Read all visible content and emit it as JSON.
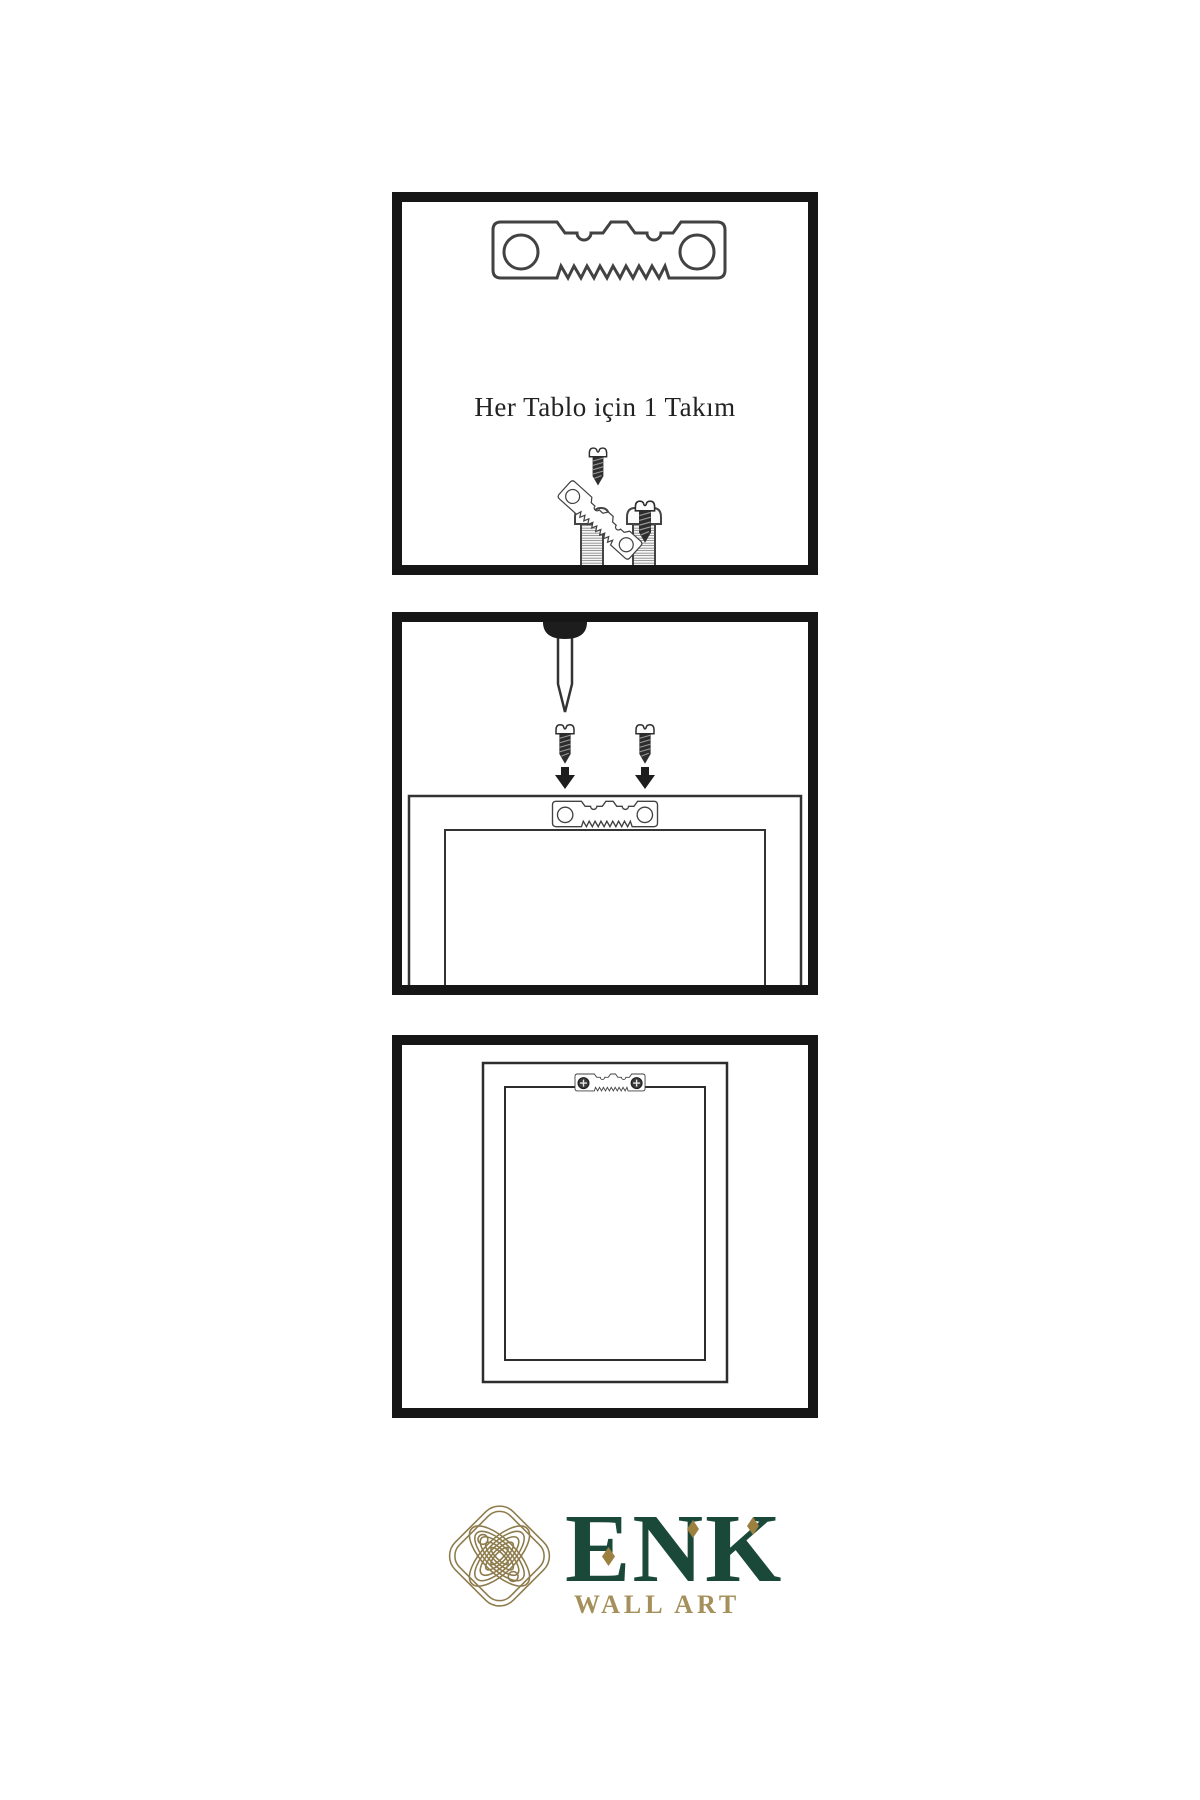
{
  "page": {
    "background": "#ffffff"
  },
  "steps": [
    {
      "name": "hardware-kit",
      "caption": "Her Tablo için 1 Takım",
      "items": [
        "sawtooth-hanger",
        "screw",
        "screw",
        "small-dark-screw",
        "tilted-sawtooth-hanger",
        "small-dark-screw"
      ]
    },
    {
      "name": "attach-hanger-to-frame-back",
      "items": [
        "wall-nail",
        "dark-screw",
        "dark-screw",
        "down-arrow",
        "down-arrow",
        "frame-back",
        "sawtooth-hanger"
      ]
    },
    {
      "name": "hang-frame-on-wall",
      "items": [
        "framed-art",
        "installed-sawtooth-hanger"
      ]
    }
  ],
  "brand": {
    "name": "ENK",
    "tagline": "WALL ART",
    "logo": "interlaced-knot",
    "colors": {
      "green": "#1a4939",
      "gold": "#a5905c",
      "knot": "#8d7b4b",
      "diamond": "#9c8040"
    }
  },
  "style": {
    "panel_border": "#161616",
    "ink": "#3a3a3a"
  }
}
